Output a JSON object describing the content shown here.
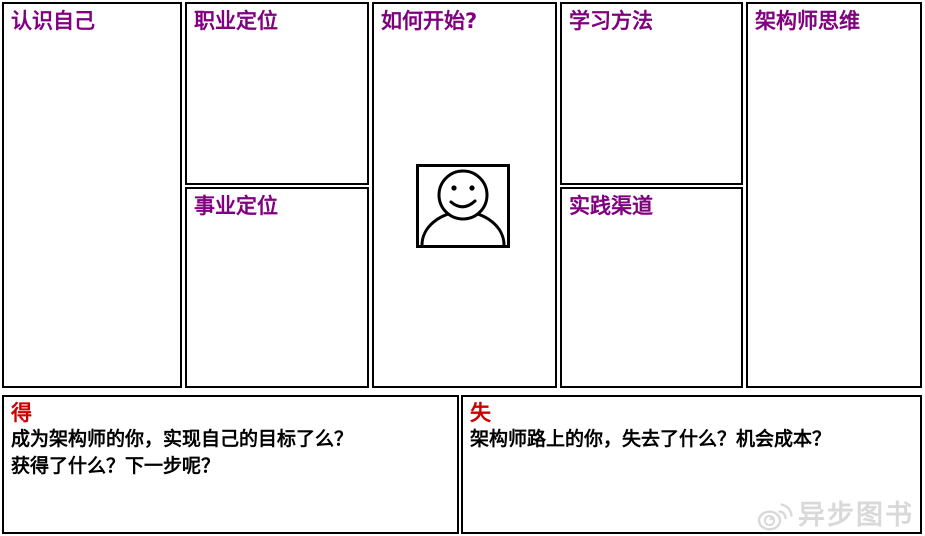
{
  "canvas": {
    "columns": [
      {
        "id": "know-yourself",
        "title": "认识自己"
      },
      {
        "id": "positioning",
        "title": "职业定位",
        "subtitle": "事业定位"
      },
      {
        "id": "how-to-start",
        "title": "如何开始?"
      },
      {
        "id": "learning",
        "title": "学习方法",
        "subtitle": "实践渠道"
      },
      {
        "id": "architect-mindset",
        "title": "架构师思维"
      }
    ]
  },
  "bottom": {
    "gain": {
      "label": "得",
      "lines": [
        "成为架构师的你，实现自己的目标了么？",
        "获得了什么？下一步呢？"
      ]
    },
    "loss": {
      "label": "失",
      "text": "架构师路上的你，失去了什么？机会成本？"
    }
  },
  "watermark": {
    "text": "异步图书",
    "icon": "weibo-eye-icon"
  },
  "icons": {
    "center": "person-smiley-icon"
  },
  "colors": {
    "heading_purple": "#800080",
    "accent_red": "#cc0000",
    "border_black": "#000000",
    "watermark_gray": "#d9d9d9",
    "background": "#ffffff"
  }
}
